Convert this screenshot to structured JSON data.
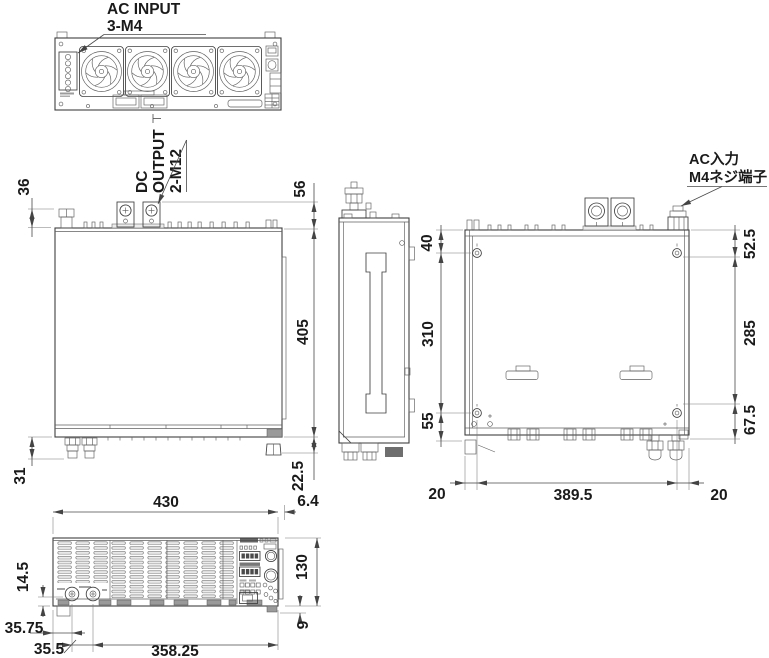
{
  "drawing": {
    "labels": {
      "ac_input_en_line1": "AC INPUT",
      "ac_input_en_line2": "3-M4",
      "dc_output_line1": "DC",
      "dc_output_line2": "OUTPUT",
      "dc_output_line3": "2-M12",
      "ac_input_jp_line1": "AC入力",
      "ac_input_jp_line2": "M4ネジ端子"
    },
    "dimensions": {
      "rear_block_height": "36",
      "dc_terminal_height": "56",
      "depth": "405",
      "left_foot_height": "31",
      "right_foot_height": "22.5",
      "front_width": "430",
      "panel_offset": "6.4",
      "hole_front_offset": "40",
      "hole_pitch_depth": "310",
      "hole_rear_offset": "55",
      "right_front_offset": "52.5",
      "right_mid_span": "285",
      "right_rear_offset": "67.5",
      "bottom_left_margin": "20",
      "hole_pitch_width": "389.5",
      "bottom_right_margin": "20",
      "front_connector_height": "14.5",
      "front_height": "130",
      "front_foot_height": "9",
      "front_left_offset": "35.75",
      "front_connector_pitch": "35.5",
      "front_right_span": "358.25"
    },
    "colors": {
      "line": "#3f3f3f",
      "dimension_line": "#4a4a4a",
      "text": "#1a1a1a",
      "background": "#ffffff"
    }
  }
}
